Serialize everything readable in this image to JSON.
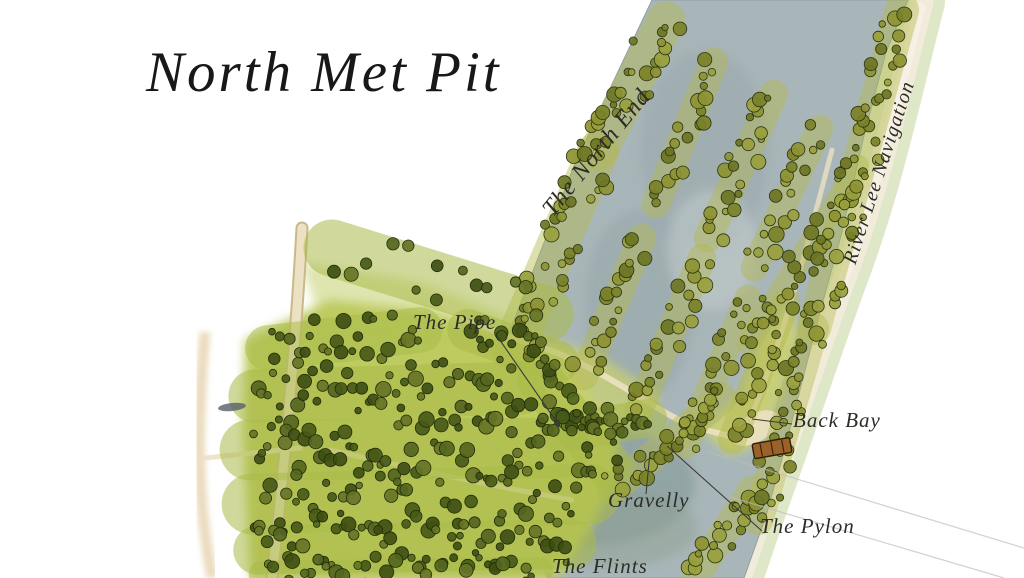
{
  "map": {
    "title": "North Met Pit",
    "labels": {
      "north_end": "The North End",
      "river": "River Lee Navigation",
      "pipe": "The Pipe",
      "back_bay": "Back Bay",
      "gravelly": "Gravelly",
      "pylon": "The Pylon",
      "flints": "The Flints"
    },
    "colors": {
      "paper": "#ffffff",
      "water": "#a9b6b9",
      "water_deep": "#7f9795",
      "water_mid": "#93a3a8",
      "water_light": "#c6cdcd",
      "water_green": "#8fa08f",
      "canopy": "#becb60",
      "grass": "#ccd36d",
      "river": "#f0ecd9",
      "bank": "#dfe7c9",
      "path": "#ece1c2",
      "shore_tan": "#e6d3ae",
      "barge": "#9a6228",
      "ink": "#23241f",
      "tree_lake_fills": [
        "#8d9232",
        "#7a8128",
        "#99a03d",
        "#6c7524"
      ],
      "tree_lake_stroke": "#2c3510",
      "tree_wood_fills": [
        "#55661f",
        "#485a18",
        "#667427",
        "#3f4f14"
      ],
      "tree_wood_stroke": "#222d0a",
      "underlay_lake": "#b3b94d",
      "underlay_wood": "#a9bb4a"
    }
  }
}
